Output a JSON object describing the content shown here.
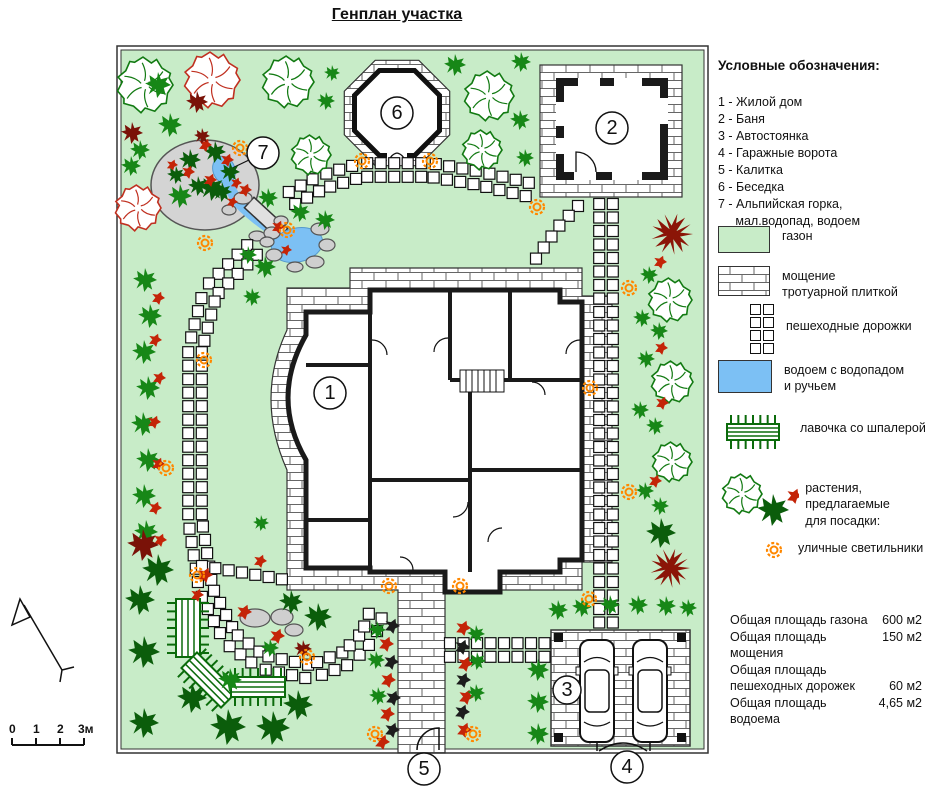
{
  "title": "Генплан участка",
  "legend": {
    "heading": "Условные обозначения:",
    "items": [
      "1 - Жилой дом",
      "2 - Баня",
      "3 - Автостоянка",
      "4 - Гаражные ворота",
      "5 - Калитка",
      "6 - Беседка",
      "7 - Альпийская горка,\n     мал.водопад, водоем"
    ],
    "symbols": {
      "lawn": "газон",
      "paving": "мощение\nтротуарной плиткой",
      "paths": "пешеходные дорожки",
      "pond": "водоем с водопадом\nи ручьем",
      "bench": "лавочка со шпалерой",
      "plants": "растения, предлагаемые\nдля посадки:",
      "lamps": "уличные светильники"
    }
  },
  "stats": [
    {
      "label": "Общая площадь газона",
      "value": "600 м2"
    },
    {
      "label": "Общая площадь мощения",
      "value": "150 м2"
    },
    {
      "label": "Общая площадь",
      "value": ""
    },
    {
      "label": "пешеходных дорожек",
      "value": "60 м2"
    },
    {
      "label": "Общая площадь водоема",
      "value": "4,65 м2"
    }
  ],
  "scale": {
    "labels": [
      "0",
      "1",
      "2",
      "3м"
    ],
    "xs": [
      9,
      33,
      57,
      78
    ]
  },
  "colors": {
    "lawn": "#c8ecc8",
    "pond": "#7cc0f4",
    "lamp": "#ff8800",
    "green": "#178717",
    "green_dark": "#0b5d0b",
    "tree_green": "#127a12",
    "tree_red": "#c03020",
    "red_plant": "#c42408",
    "dark_red": "#7a1208",
    "dark_red_tree": "#8b1507",
    "black_plant": "#1c1c1c",
    "bench": "#0b6b0b"
  },
  "plan": {
    "frame": {
      "outer": [
        7,
        6,
        591,
        707
      ],
      "inner": [
        11,
        10,
        583,
        699
      ]
    },
    "paving_d": "M240,248 L240,228 L472,228 L472,256 L502,256 L502,522 L472,522 L472,550 L335,550 L335,713 L288,713 L288,550 L177,550 L177,430 Q145,358 177,290 L177,248 Z",
    "house": {
      "outline_d": "M196,272 L260,272 L260,250 L450,250 L450,262 L472,262 L472,520 L450,520 L450,532 L390,532 L390,552 L335,552 L335,532 L260,532 L260,528 L196,528 L196,420 Q160,358 196,295 Z",
      "walls_d": "M260,272 V528 M196,325 H260 M196,480 H260 M340,250 V340 M400,250 V340 M340,340 H472 M360,340 V532 M360,430 H472 M260,440 H360",
      "doors_d": "M262,300 A15,15 0 0 1 277,315 M338,298 A14,14 0 0 0 324,312 M358,462 A15,15 0 0 1 343,477 M392,488 A14,14 0 0 0 378,502 M422,342 A13,13 0 0 1 435,355 M303,530 A13,13 0 0 0 290,517 M470,300 A14,14 0 0 0 456,314",
      "stairs": {
        "x": 350,
        "y": 330,
        "w": 44,
        "h": 22
      },
      "stairs_d": "M356,330 V352 M362,330 V352 M368,330 V352 M374,330 V352 M380,330 V352 M386,330 V352"
    },
    "bath": {
      "apron": [
        430,
        25,
        142,
        132
      ],
      "wall": [
        446,
        38,
        112,
        102
      ],
      "inner": [
        454,
        46,
        96,
        86
      ],
      "windows": [
        [
          468,
          38,
          22,
          8
        ],
        [
          504,
          38,
          28,
          8
        ],
        [
          446,
          62,
          8,
          24
        ],
        [
          446,
          98,
          8,
          16
        ],
        [
          550,
          58,
          8,
          26
        ],
        [
          502,
          132,
          30,
          8
        ],
        [
          464,
          132,
          22,
          8
        ]
      ],
      "door_d": "M466,132 V112 A20,20 0 0 1 486,132"
    },
    "gazebo": {
      "outer_pts": "339.7,94.8 308.8,125.7 265.2,125.7 234.3,94.8 234.3,51.2 265.2,20.3 308.8,20.3 339.7,51.2",
      "inner_pts": "329.5,90.6 304.6,115.5 269.4,115.5 244.5,90.6 244.5,55.4 269.4,30.5 304.6,30.5 329.5,55.4",
      "gap": [
        277,
        110,
        20,
        14
      ],
      "arcs_d": "M279,123 A10,10 0 0 1 287,113 M295,123 A10,10 0 0 0 287,113"
    },
    "parking": {
      "pad": [
        441,
        590,
        139,
        116
      ],
      "posts": [
        [
          444,
          593
        ],
        [
          567,
          593
        ],
        [
          444,
          693
        ],
        [
          567,
          693
        ]
      ],
      "cars": [
        {
          "x": 470,
          "y": 600
        },
        {
          "x": 523,
          "y": 600
        }
      ],
      "gates_d": "M487,702 V711 M540,702 V711 M489,711 Q513,695 537,711"
    },
    "alpine": {
      "mound": [
        95,
        145,
        54,
        45
      ],
      "stream_d": "M115,131 Q119,153 133,167 Q148,181 164,191 Q174,197 180,201",
      "bridge_pts": "134.4,167.7 144,157.3 177.6,188.5 168,198.7",
      "pond_up": [
        114,
        130,
        11,
        14,
        -20
      ],
      "pond_low": [
        187,
        205,
        26,
        17,
        -12
      ],
      "leader7_d": "M139,120 L116,131"
    },
    "gate5_d": "M329,710 V688 A22,22 0 0 0 307,710",
    "rocks": [
      [
        133,
        158,
        9,
        6
      ],
      [
        119,
        170,
        7,
        5
      ],
      [
        147,
        196,
        8,
        5
      ],
      [
        171,
        181,
        7,
        5
      ],
      [
        162,
        193,
        8,
        6
      ],
      [
        210,
        189,
        9,
        6
      ],
      [
        217,
        205,
        8,
        6
      ],
      [
        205,
        222,
        9,
        6
      ],
      [
        185,
        227,
        8,
        5
      ],
      [
        164,
        215,
        8,
        6
      ],
      [
        157,
        202,
        7,
        5
      ],
      [
        145,
        578,
        15,
        9
      ],
      [
        172,
        577,
        11,
        8
      ],
      [
        184,
        590,
        9,
        6
      ]
    ],
    "benches": [
      {
        "x": 78,
        "y": 588,
        "len": 50,
        "wid": 24,
        "rot": 90
      },
      {
        "x": 99,
        "y": 640,
        "len": 48,
        "wid": 22,
        "rot": 45
      },
      {
        "x": 148,
        "y": 647,
        "len": 46,
        "wid": 20,
        "rot": 0
      }
    ],
    "routes": [
      {
        "d": 1,
        "pts": [
          [
            142,
            210
          ],
          [
            100,
            252
          ],
          [
            85,
            310
          ],
          [
            85,
            480
          ],
          [
            96,
            550
          ],
          [
            120,
            598
          ],
          [
            152,
            622
          ],
          [
            200,
            632
          ],
          [
            237,
            618
          ],
          [
            258,
            596
          ],
          [
            266,
            574
          ]
        ]
      },
      {
        "d": 0,
        "pts": [
          [
            92,
            526
          ],
          [
            135,
            533
          ],
          [
            176,
            540
          ]
        ]
      },
      {
        "d": 1,
        "pts": [
          [
            182,
            158
          ],
          [
            212,
            142
          ],
          [
            252,
            130
          ],
          [
            320,
            130
          ],
          [
            368,
            138
          ],
          [
            424,
            151
          ]
        ]
      },
      {
        "d": 0,
        "pts": [
          [
            468,
            166
          ],
          [
            449,
            186
          ],
          [
            434,
            207
          ],
          [
            423,
            223
          ]
        ]
      },
      {
        "d": 1,
        "pts": [
          [
            496,
            164
          ],
          [
            496,
            588
          ]
        ]
      },
      {
        "d": 1,
        "pts": [
          [
            340,
            610
          ],
          [
            444,
            610
          ]
        ]
      }
    ],
    "lamps": [
      [
        95,
        203
      ],
      [
        130,
        108
      ],
      [
        252,
        121
      ],
      [
        320,
        121
      ],
      [
        427,
        167
      ],
      [
        519,
        248
      ],
      [
        480,
        348
      ],
      [
        519,
        452
      ],
      [
        479,
        559
      ],
      [
        94,
        320
      ],
      [
        56,
        428
      ],
      [
        87,
        535
      ],
      [
        197,
        617
      ],
      [
        265,
        694
      ],
      [
        363,
        694
      ],
      [
        279,
        546
      ],
      [
        350,
        546
      ],
      [
        177,
        190
      ]
    ],
    "markers": [
      {
        "n": "1",
        "x": 220,
        "y": 353,
        "r": 16
      },
      {
        "n": "2",
        "x": 502,
        "y": 88,
        "r": 16
      },
      {
        "n": "3",
        "x": 457,
        "y": 650,
        "r": 14
      },
      {
        "n": "4",
        "x": 517,
        "y": 727,
        "r": 16
      },
      {
        "n": "5",
        "x": 314,
        "y": 729,
        "r": 16
      },
      {
        "n": "6",
        "x": 287,
        "y": 73,
        "r": 16
      },
      {
        "n": "7",
        "x": 153,
        "y": 113,
        "r": 16
      }
    ],
    "trees": [
      [
        "og",
        35,
        45,
        28
      ],
      [
        "or",
        102,
        40,
        28
      ],
      [
        "og",
        178,
        42,
        26
      ],
      [
        "sg",
        222,
        33,
        8
      ],
      [
        "sg",
        216,
        61,
        9
      ],
      [
        "sg",
        345,
        25,
        11
      ],
      [
        "sg",
        411,
        22,
        10
      ],
      [
        "og",
        379,
        56,
        25
      ],
      [
        "og",
        372,
        110,
        20
      ],
      [
        "sg",
        410,
        80,
        10
      ],
      [
        "sg",
        415,
        118,
        9
      ],
      [
        "og",
        201,
        115,
        20
      ],
      [
        "sg",
        48,
        45,
        13
      ],
      [
        "dr",
        87,
        62,
        11
      ],
      [
        "sg",
        60,
        85,
        12
      ],
      [
        "dr",
        22,
        93,
        11
      ],
      [
        "sg",
        30,
        110,
        10
      ],
      [
        "sg",
        21,
        126,
        10
      ],
      [
        "or",
        28,
        168,
        23
      ],
      [
        "sg",
        70,
        156,
        12
      ],
      [
        "dg",
        102,
        148,
        13
      ],
      [
        "dg",
        80,
        120,
        11
      ],
      [
        "dg",
        105,
        112,
        11
      ],
      [
        "dg",
        120,
        132,
        10
      ],
      [
        "dg",
        88,
        146,
        10
      ],
      [
        "dg",
        112,
        152,
        10
      ],
      [
        "rp",
        95,
        105,
        7
      ],
      [
        "rp",
        117,
        120,
        7
      ],
      [
        "rp",
        78,
        132,
        7
      ],
      [
        "rp",
        100,
        140,
        7
      ],
      [
        "rp",
        126,
        143,
        6
      ],
      [
        "dr",
        92,
        96,
        8
      ],
      [
        "rp",
        62,
        125,
        6
      ],
      [
        "dg",
        66,
        135,
        9
      ],
      [
        "sg",
        158,
        158,
        10
      ],
      [
        "sg",
        190,
        172,
        10
      ],
      [
        "sg",
        215,
        180,
        10
      ],
      [
        "sg",
        155,
        227,
        11
      ],
      [
        "rp",
        135,
        150,
        7
      ],
      [
        "rp",
        168,
        187,
        7
      ],
      [
        "rp",
        122,
        162,
        6
      ],
      [
        "sg",
        138,
        215,
        9
      ],
      [
        "rp",
        176,
        210,
        6
      ],
      [
        "sg",
        35,
        240,
        12
      ],
      [
        "sg",
        40,
        276,
        12
      ],
      [
        "sg",
        34,
        312,
        12
      ],
      [
        "sg",
        38,
        348,
        12
      ],
      [
        "sg",
        33,
        384,
        12
      ],
      [
        "sg",
        38,
        420,
        12
      ],
      [
        "sg",
        34,
        456,
        12
      ],
      [
        "sg",
        36,
        492,
        12
      ],
      [
        "rp",
        48,
        258,
        7
      ],
      [
        "rp",
        45,
        300,
        7
      ],
      [
        "rp",
        49,
        338,
        7
      ],
      [
        "rp",
        44,
        382,
        7
      ],
      [
        "rp",
        48,
        424,
        7
      ],
      [
        "rp",
        45,
        468,
        7
      ],
      [
        "rp",
        50,
        500,
        7
      ],
      [
        "dr",
        33,
        505,
        16
      ],
      [
        "dg",
        48,
        530,
        16
      ],
      [
        "dg",
        30,
        560,
        15
      ],
      [
        "dg",
        34,
        612,
        16
      ],
      [
        "dg",
        34,
        683,
        15
      ],
      [
        "dg",
        82,
        658,
        15
      ],
      [
        "dg",
        118,
        687,
        18
      ],
      [
        "dg",
        163,
        688,
        17
      ],
      [
        "dg",
        188,
        665,
        15
      ],
      [
        "dg",
        181,
        562,
        12
      ],
      [
        "dg",
        208,
        577,
        14
      ],
      [
        "sg",
        120,
        640,
        12
      ],
      [
        "rp",
        95,
        535,
        8
      ],
      [
        "rp",
        87,
        555,
        7
      ],
      [
        "rp",
        134,
        572,
        8
      ],
      [
        "rp",
        167,
        596,
        8
      ],
      [
        "dr",
        193,
        609,
        9
      ],
      [
        "sg",
        160,
        608,
        9
      ],
      [
        "sg",
        151,
        483,
        8
      ],
      [
        "rp",
        150,
        521,
        7
      ],
      [
        "sg",
        142,
        257,
        9
      ],
      [
        "sg",
        267,
        590,
        9
      ],
      [
        "bp",
        282,
        586,
        8
      ],
      [
        "rp",
        276,
        604,
        8
      ],
      [
        "bp",
        281,
        622,
        8
      ],
      [
        "sg",
        266,
        620,
        9
      ],
      [
        "rp",
        278,
        640,
        8
      ],
      [
        "bp",
        283,
        658,
        8
      ],
      [
        "sg",
        268,
        656,
        9
      ],
      [
        "rp",
        277,
        674,
        8
      ],
      [
        "bp",
        282,
        690,
        8
      ],
      [
        "rp",
        272,
        702,
        8
      ],
      [
        "rp",
        353,
        588,
        8
      ],
      [
        "sg",
        366,
        594,
        9
      ],
      [
        "bp",
        352,
        607,
        8
      ],
      [
        "rp",
        355,
        624,
        8
      ],
      [
        "sg",
        367,
        621,
        9
      ],
      [
        "bp",
        353,
        640,
        8
      ],
      [
        "rp",
        356,
        657,
        8
      ],
      [
        "sg",
        366,
        653,
        9
      ],
      [
        "bp",
        352,
        672,
        8
      ],
      [
        "rp",
        354,
        690,
        8
      ],
      [
        "sg",
        428,
        630,
        11
      ],
      [
        "sg",
        428,
        662,
        11
      ],
      [
        "sg",
        428,
        694,
        11
      ],
      [
        "sg",
        448,
        570,
        10
      ],
      [
        "sg",
        472,
        567,
        10
      ],
      [
        "sg",
        500,
        565,
        10
      ],
      [
        "sg",
        528,
        565,
        10
      ],
      [
        "sg",
        556,
        566,
        10
      ],
      [
        "sg",
        578,
        568,
        9
      ],
      [
        "drt",
        562,
        194,
        21
      ],
      [
        "rp",
        550,
        222,
        7
      ],
      [
        "sg",
        539,
        235,
        9
      ],
      [
        "og",
        560,
        260,
        22
      ],
      [
        "sg",
        532,
        278,
        9
      ],
      [
        "sg",
        549,
        291,
        9
      ],
      [
        "rp",
        551,
        308,
        7
      ],
      [
        "sg",
        536,
        319,
        9
      ],
      [
        "og",
        562,
        342,
        21
      ],
      [
        "sg",
        530,
        370,
        9
      ],
      [
        "rp",
        552,
        363,
        7
      ],
      [
        "sg",
        545,
        386,
        9
      ],
      [
        "og",
        562,
        422,
        20
      ],
      [
        "rp",
        545,
        441,
        7
      ],
      [
        "sg",
        535,
        451,
        9
      ],
      [
        "sg",
        550,
        466,
        9
      ],
      [
        "dg",
        551,
        493,
        15
      ],
      [
        "drt",
        560,
        528,
        20
      ]
    ]
  },
  "legend_icons": {
    "bench": {
      "x": 35,
      "y": 24,
      "len": 44,
      "wid": 16,
      "rot": 0
    },
    "plants": [
      [
        "og",
        24,
        28,
        20
      ],
      [
        "dg",
        55,
        44,
        16
      ],
      [
        "rp",
        76,
        30,
        8
      ]
    ],
    "lamp": [
      12,
      12
    ]
  }
}
